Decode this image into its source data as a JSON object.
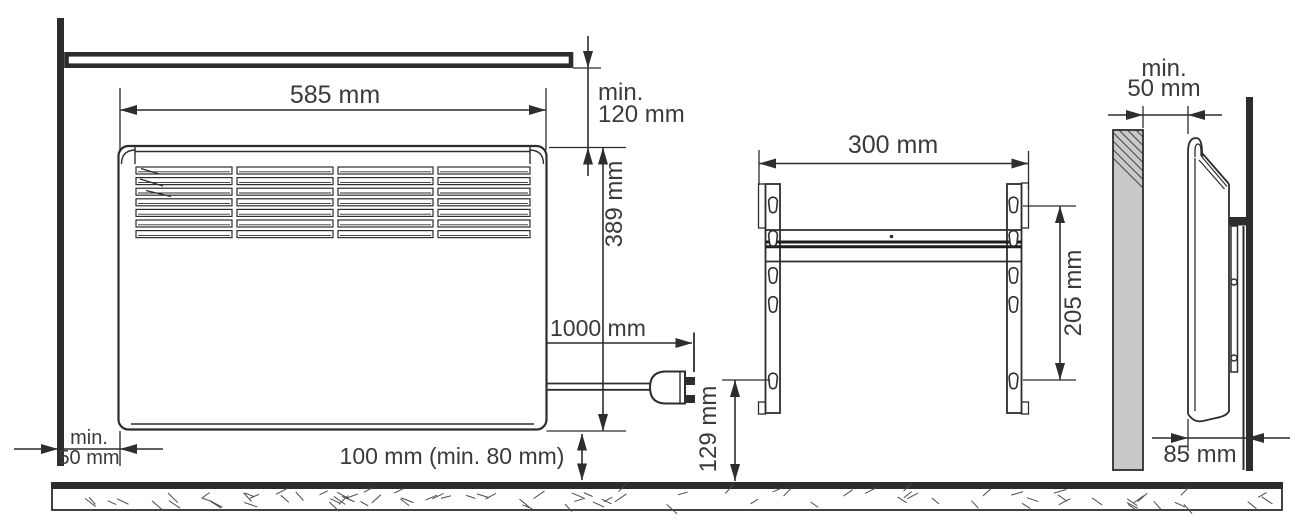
{
  "figure": {
    "type": "heater-installation-diagram",
    "views": {
      "front": {
        "width": "585 mm",
        "height": "389 mm",
        "ceiling_clearance": [
          "min.",
          "120 mm"
        ],
        "cord_length": "1000 mm",
        "floor_clearance": "100 mm (min. 80 mm)",
        "left_wall_clearance": [
          "min.",
          "50 mm"
        ],
        "grille": {
          "columns": 4,
          "rows": 7
        }
      },
      "bracket": {
        "width": "300 mm",
        "hole_spacing": "205 mm",
        "bottom_hole_height": "129 mm",
        "slots_per_rail": 5
      },
      "side": {
        "front_clearance": [
          "min.",
          "50 mm"
        ],
        "depth": "85 mm"
      }
    },
    "colors": {
      "line": "#2d2d2d",
      "text": "#3a3a3a",
      "obstacle_fill": "#c9c9c9",
      "background": "#ffffff"
    }
  }
}
